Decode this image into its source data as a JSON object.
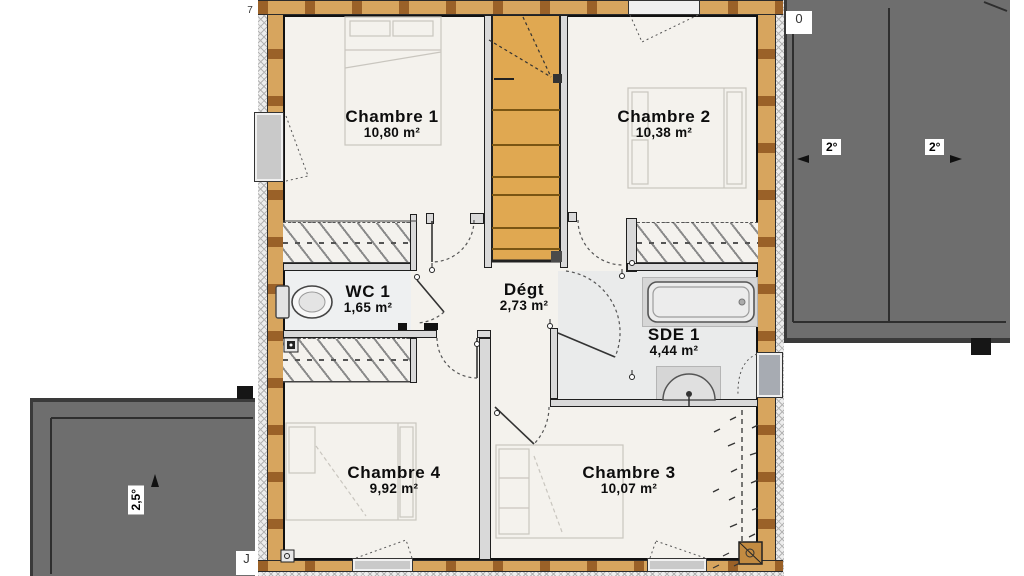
{
  "plan_type": "floor-plan",
  "rooms": [
    {
      "name": "Chambre 1",
      "area": "10,80 m²"
    },
    {
      "name": "Chambre 2",
      "area": "10,38 m²"
    },
    {
      "name": "WC 1",
      "area": "1,65 m²"
    },
    {
      "name": "Dégt",
      "area": "2,73 m²"
    },
    {
      "name": "SDE 1",
      "area": "4,44 m²"
    },
    {
      "name": "Chambre 4",
      "area": "9,92 m²"
    },
    {
      "name": "Chambre 3",
      "area": "10,07 m²"
    }
  ],
  "roof_annotations": {
    "right_roof": {
      "slope_left": "2°",
      "slope_right": "2°"
    },
    "left_roof": {
      "slope": "2,5°"
    }
  },
  "partial_labels": {
    "top_left": "7",
    "right_roof_box": "0",
    "left_roof_box": "J"
  },
  "fixtures": [
    "stairs",
    "toilet",
    "bathtub",
    "washbasin",
    "chimney",
    "chimney"
  ],
  "colors": {
    "wall_wood": "#d7a55e",
    "wall_stud": "#9a6128",
    "insulation": "#ededed",
    "roof_gray": "#6e6e6e",
    "stairs": "#e0a851",
    "floor": "#f4f2ed",
    "wet_room": "#eaebeb"
  }
}
